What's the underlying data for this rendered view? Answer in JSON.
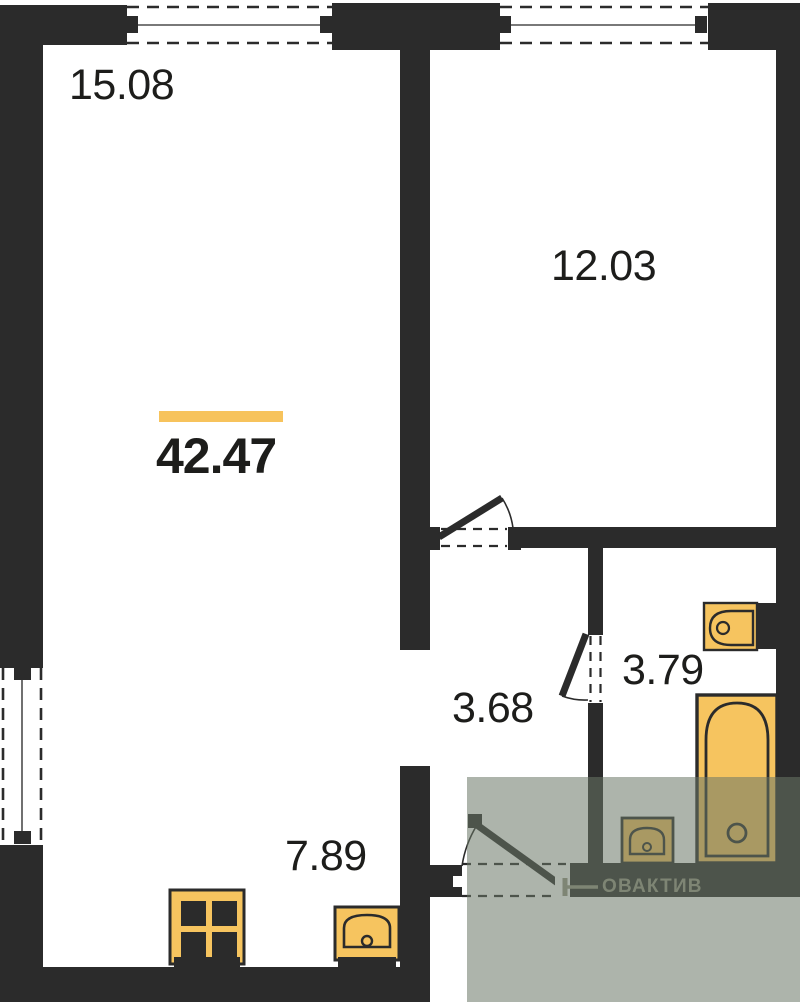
{
  "plan": {
    "title": "apartment floor plan",
    "total_area": "42.47",
    "rooms": [
      {
        "id": "room-top-left",
        "area": "15.08"
      },
      {
        "id": "room-top-right",
        "area": "12.03"
      },
      {
        "id": "hallway",
        "area": "3.68"
      },
      {
        "id": "bathroom",
        "area": "3.79"
      },
      {
        "id": "kitchen-zone",
        "area": "7.89"
      }
    ],
    "watermark": "ОВАКТИВ"
  },
  "colors": {
    "wall": "#2b2b2b",
    "fixture": "#f6c45f",
    "bar": "#f7c35c",
    "label": "#1d1d1b",
    "overlay": "rgba(106,118,102,0.55)",
    "watermark": "#7e8574",
    "bg": "#ffffff"
  }
}
